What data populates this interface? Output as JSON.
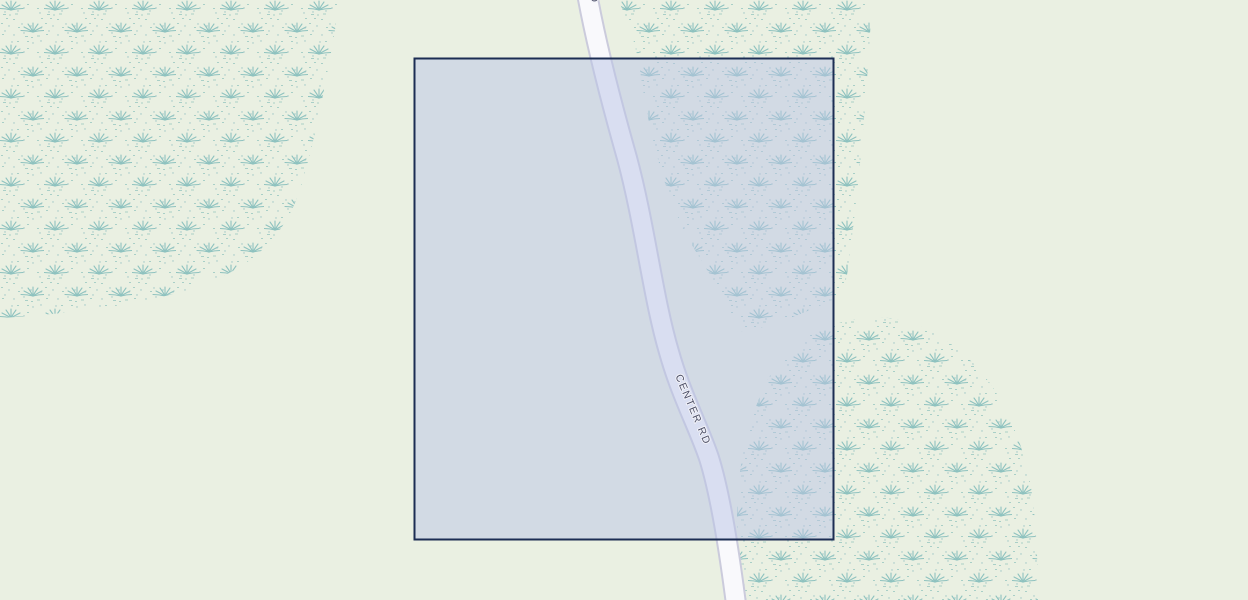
{
  "map": {
    "background_color": "#eaf0e2",
    "road": {
      "label": "CENTER RD",
      "top_label_fragment": "CENTER RD",
      "surface_color": "#f9f9fc",
      "casing_color": "#cbcbdc",
      "label_color": "#4b4e66"
    },
    "wetland": {
      "tuft_color": "#8ec2bf",
      "speckle_color": "#a9cfc7",
      "dot_color": "#9cc4c4"
    },
    "selection": {
      "fill_color": "#b9c3e6",
      "border_color": "#1c2d53"
    }
  }
}
